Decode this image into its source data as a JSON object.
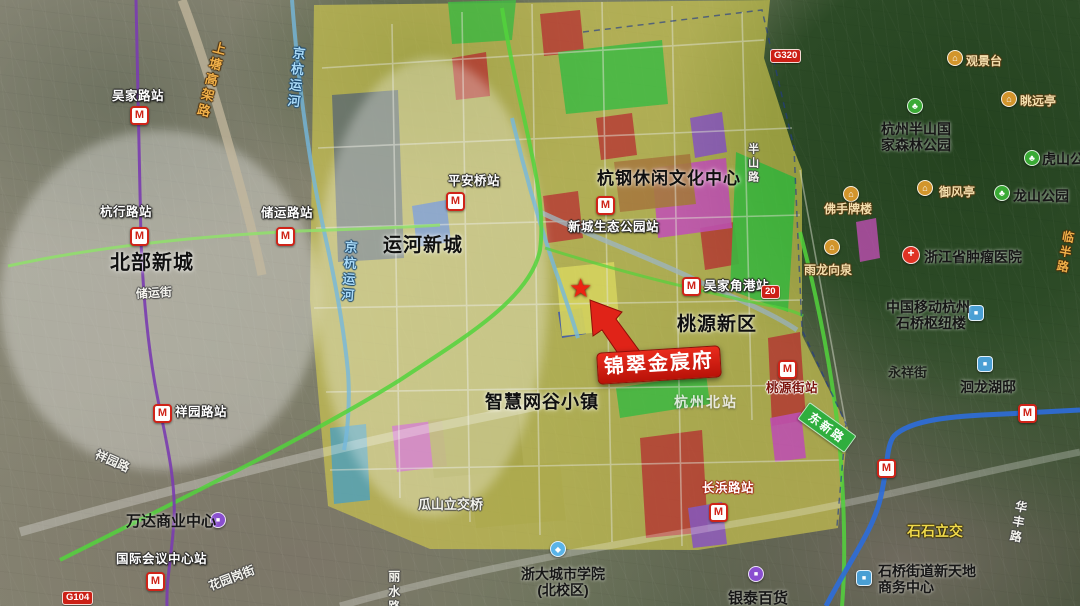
{
  "icons": {
    "metro": "M",
    "star": "★",
    "park": "♣",
    "scenic": "⌂",
    "hospital": "+",
    "building": "■",
    "mall": "■",
    "school": "◆"
  },
  "highlight": {
    "name": "锦翠金宸府"
  },
  "districts": [
    {
      "text": "北部新城"
    },
    {
      "text": "运河新城"
    },
    {
      "text": "杭钢休闲文化中心"
    },
    {
      "text": "桃源新区"
    },
    {
      "text": "智慧网谷小镇"
    }
  ],
  "stations": [
    {
      "name": "吴家路站"
    },
    {
      "name": "杭行路站"
    },
    {
      "name": "储运路站"
    },
    {
      "name": "平安桥站"
    },
    {
      "name": "新城生态公园站"
    },
    {
      "name": "吴家角港站",
      "badge": "20"
    },
    {
      "name": "桃源街站"
    },
    {
      "name": "长浜路站"
    },
    {
      "name": "祥园路站"
    },
    {
      "name": "国际会议中心站"
    }
  ],
  "pois": [
    {
      "name": "观景台",
      "type": "scenic"
    },
    {
      "name": "眺远亭",
      "type": "scenic"
    },
    {
      "name": "御风亭",
      "type": "scenic"
    },
    {
      "name": "佛手牌楼",
      "type": "scenic"
    },
    {
      "name": "雨龙向泉",
      "type": "scenic"
    },
    {
      "name": "杭州半山国",
      "name2": "家森林公园",
      "type": "park"
    },
    {
      "name": "虎山公园",
      "type": "park"
    },
    {
      "name": "龙山公园",
      "type": "park"
    },
    {
      "name": "浙江省肿瘤医院",
      "type": "hospital"
    },
    {
      "name": "中国移动杭州",
      "name2": "石桥枢纽楼",
      "type": "building"
    },
    {
      "name": "洄龙湖邸",
      "type": "building"
    },
    {
      "name": "石桥街道新天地",
      "name2": "商务中心",
      "type": "building"
    },
    {
      "name": "万达商业中心",
      "type": "mall"
    },
    {
      "name": "银泰百货",
      "type": "mall"
    },
    {
      "name": "浙大城市学院",
      "name2": "(北校区)",
      "type": "school"
    },
    {
      "name": "杭州北站",
      "type": "rail"
    }
  ],
  "roads": [
    {
      "name": "上塘高架路"
    },
    {
      "name": "京杭运河"
    },
    {
      "name": "半山路"
    },
    {
      "name": "东新路"
    },
    {
      "name": "瓜山立交桥"
    },
    {
      "name": "祥园路"
    },
    {
      "name": "储运街"
    },
    {
      "name": "花园岗街"
    },
    {
      "name": "丽水路"
    },
    {
      "name": "华丰路"
    },
    {
      "name": "永祥街"
    },
    {
      "name": "石石立交"
    },
    {
      "name": "临半路"
    }
  ],
  "badges": {
    "g320": "G320",
    "g104": "G104"
  },
  "colors": {
    "highlight_red": "#e02318",
    "zone_yellow": "#cfc84e",
    "zone_magenta": "#cf4ec2",
    "zone_green": "#3cc53f",
    "metro_red": "#cf2318",
    "metro_blue": "#2e6cd8",
    "metro_purple": "#7a3cb0"
  }
}
